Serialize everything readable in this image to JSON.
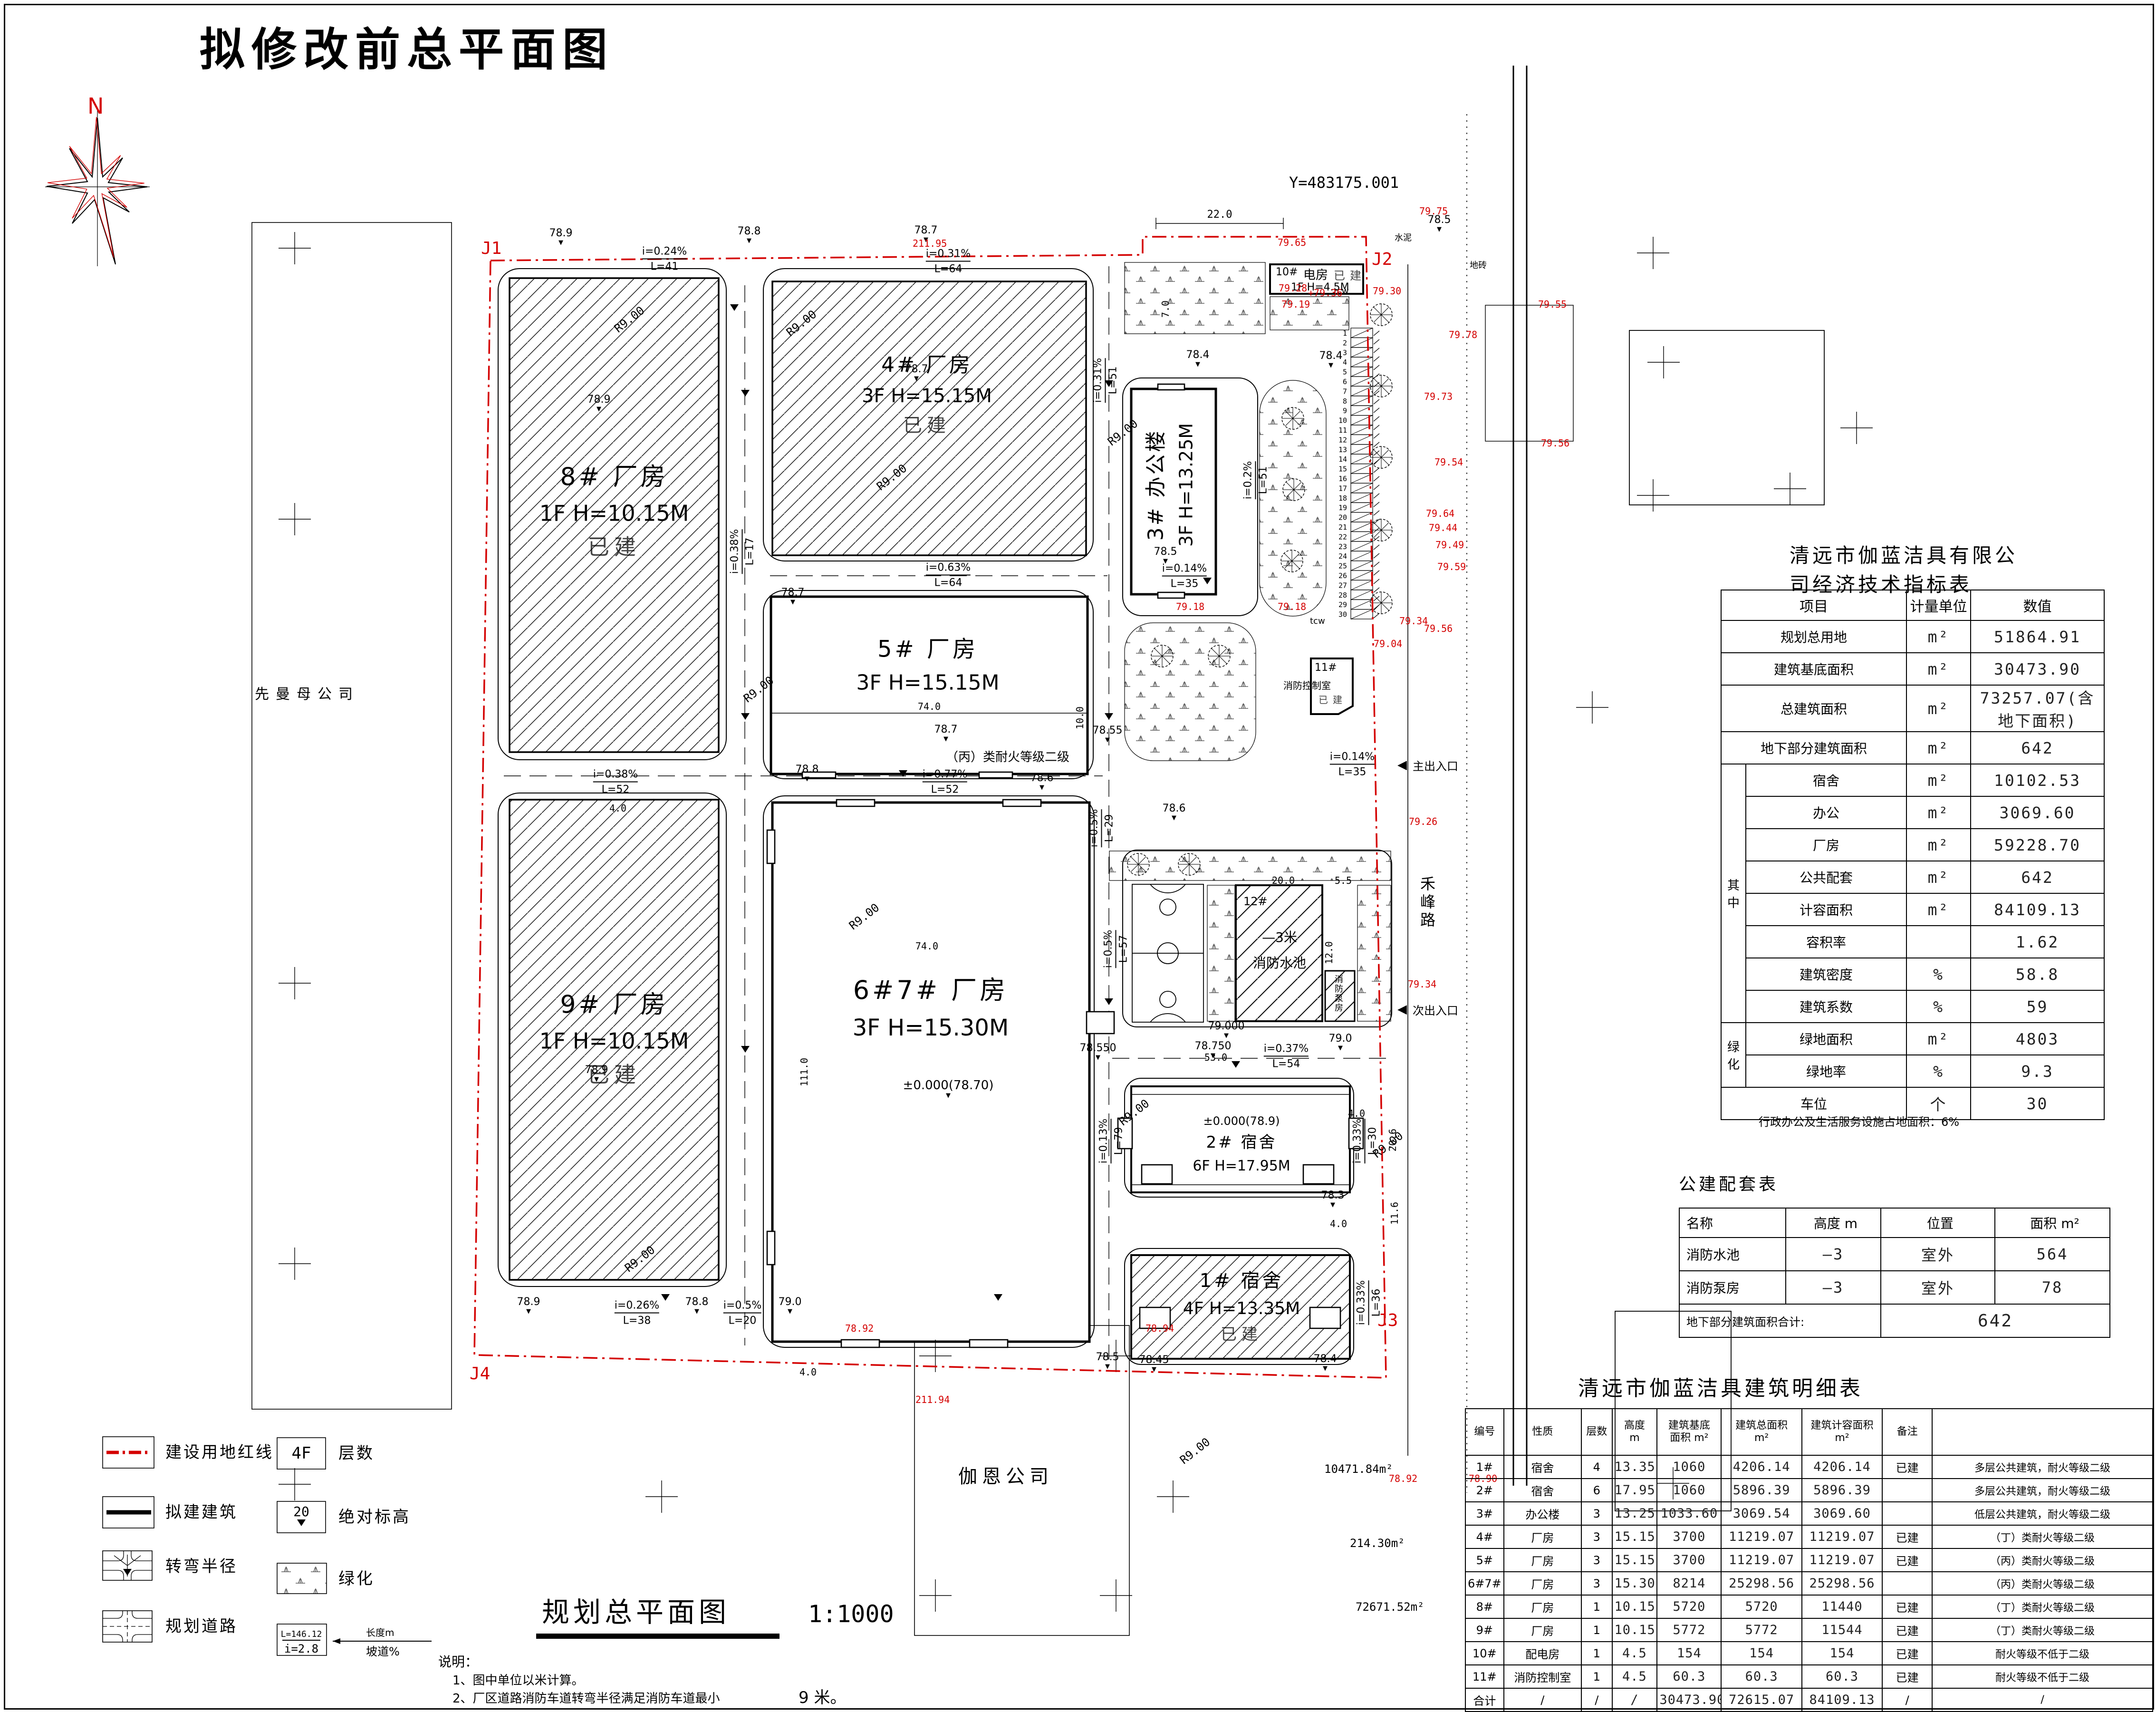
{
  "page": {
    "title": "拟修改前总平面图",
    "y_coord": "Y=483175.001"
  },
  "compass": {
    "n": "N"
  },
  "markers": {
    "j1": "J1",
    "j2": "J2",
    "j3": "J3",
    "j4": "J4"
  },
  "icons": {
    "spot": "▼",
    "left": "◀",
    "up": "▲"
  },
  "labels": {
    "r9": "R9.00",
    "hefeng": "禾峰路",
    "main_ent": "主出入口",
    "sec_ent": "次出入口",
    "cement": "水泥",
    "brick": "地砖",
    "tcw": "tcw"
  },
  "neighbors": {
    "west": "先曼母公司",
    "south": "伽恩公司"
  },
  "areas": {
    "a1": "10471.84m²",
    "a2": "214.30m²",
    "a3": "72671.52m²"
  },
  "buildings": {
    "b8": {
      "name": "8# 厂房",
      "spec": "1F H=10.15M",
      "status": "已建"
    },
    "b9": {
      "name": "9# 厂房",
      "spec": "1F H=10.15M",
      "status": "已建"
    },
    "b4": {
      "name": "4# 厂房",
      "spec": "3F H=15.15M",
      "status": "已建"
    },
    "b5": {
      "name": "5# 厂房",
      "spec": "3F H=15.15M",
      "fire": "（丙）类耐火等级二级"
    },
    "b67": {
      "name": "6#7# 厂房",
      "spec": "3F H=15.30M",
      "zero": "±0.000(78.70)"
    },
    "b3": {
      "name": "3# 办公楼",
      "spec": "3F H=13.25M"
    },
    "b2": {
      "zero": "±0.000(78.9)",
      "name": "2# 宿舍",
      "spec": "6F H=17.95M"
    },
    "b1": {
      "name": "1# 宿舍",
      "spec": "4F H=13.35M",
      "status": "已建"
    },
    "b10": {
      "id": "10#",
      "name": "电房",
      "spec": "1F H=4.5M",
      "status": "已建"
    },
    "b11": {
      "id": "11#",
      "name": "消防控制室",
      "status": "已建"
    },
    "b12": {
      "id": "12#",
      "depth": "—3米",
      "name": "消防水池",
      "pump": "消防泵房"
    }
  },
  "elevs": {
    "e1": "78.9",
    "e2": "78.8",
    "e3": "78.7",
    "e4": "78.5",
    "e5": "78.9",
    "e6": "78.7",
    "e7": "78.7",
    "e8": "78.4",
    "e9": "78.4",
    "e10": "78.5",
    "e11": "78.55",
    "e12": "78.7",
    "e13": "78.8",
    "e14": "78.6",
    "e15": "78.9",
    "e16": "78.550",
    "e17": "78.750",
    "e18": "79.000",
    "e19": "79.0",
    "e20": "78.3",
    "e21": "78.5",
    "e22": "78.45",
    "e23": "78.4",
    "e24": "78.9",
    "e25": "78.8",
    "e26": "79.0",
    "e27": "78.6"
  },
  "red": {
    "r1": "79.65",
    "r2": "79.28",
    "r3": "+79.36",
    "r4": "79.19",
    "r5": "79.30",
    "r6": "79.75",
    "r7": "79.78",
    "r8": "79.73",
    "r9": "79.54",
    "r10": "79.64",
    "r11": "79.44",
    "r12": "79.49",
    "r13": "79.59",
    "r14": "79.56",
    "r15": "79.34",
    "r16": "79.04",
    "r17": "79.18",
    "r18": "79.18",
    "r19": "79.55",
    "r20": "79.56",
    "r21": "211.95",
    "r22": "211.94",
    "r23": "78.92",
    "r24": "78.94",
    "r25": "78.92",
    "r26": "78.90",
    "r27": "79.26",
    "r28": "79.34"
  },
  "dims": {
    "d22": "22.0",
    "d7": "7.0",
    "d74a": "74.0",
    "d74b": "74.0",
    "d111": "111.0",
    "d53": "53.0",
    "d20": "20.0",
    "d12": "12.0",
    "d55": "5.5",
    "d206": "20.6",
    "d116": "11.6",
    "d40": "4.0",
    "d100": "10.0"
  },
  "slopes": {
    "s1": {
      "i": "i=0.24%",
      "l": "L=41"
    },
    "s2": {
      "i": "i=0.31%",
      "l": "L=64"
    },
    "s3": {
      "i": "i=0.63%",
      "l": "L=64"
    },
    "s4": {
      "i": "i=0.38%",
      "l": "L=17"
    },
    "s5": {
      "i": "i=0.38%",
      "l": "L=52"
    },
    "s6": {
      "i": "i=0.77%",
      "l": "L=52"
    },
    "s7": {
      "i": "i=0.26%",
      "l": "L=38"
    },
    "s8": {
      "i": "i=0.5%",
      "l": "L=20"
    },
    "s9": {
      "i": "i=0.14%",
      "l": "L=35"
    },
    "s10": {
      "i": "i=0.37%",
      "l": "L=54"
    },
    "s11": {
      "i": "i=0.13%",
      "l": "L=79"
    },
    "s12": {
      "i": "i=0.33%",
      "l": "L=30"
    },
    "s13": {
      "i": "i=0.33%",
      "l": "L=36"
    },
    "s14": {
      "i": "i=0.5%",
      "l": "L=57"
    },
    "s15": {
      "i": "i=0.2%",
      "l": "L=51"
    },
    "s16": {
      "i": "i=0.31%",
      "l": "L=51"
    },
    "s17": {
      "i": "i=0.5%",
      "l": "L=29"
    },
    "s18": {
      "i": "i=0.14%",
      "l": "L=35"
    }
  },
  "parking": {
    "count": 30
  },
  "legend": {
    "redline": "建设用地红线",
    "building": "拟建建筑",
    "turn": "转弯半径",
    "road": "规划道路",
    "floors": "层数",
    "floors_sym": "4F",
    "elev": "绝对标高",
    "elev_sym": "20",
    "green": "绿化",
    "slope_top": "L=146.12",
    "slope_bot": "i=2.8",
    "len_label": "长度m",
    "grade_label": "坡道%"
  },
  "caption": {
    "text": "规划总平面图",
    "scale": "1:1000"
  },
  "notes": {
    "head": "说明：",
    "n1": "1、图中单位以米计算。",
    "n2": "2、厂区道路消防车道转弯半径满足消防车道最小",
    "n2b": "9 米。"
  },
  "econ_table": {
    "title": "清远市伽蓝洁具有限公司经济技术指标表",
    "headers": [
      "项目",
      "计量单位",
      "数值"
    ],
    "rows": [
      {
        "item": "规划总用地",
        "unit": "m²",
        "value": "51864.91"
      },
      {
        "item": "建筑基底面积",
        "unit": "m²",
        "value": "30473.90"
      },
      {
        "item": "总建筑面积",
        "unit": "m²",
        "value": "73257.07(含地下面积)"
      },
      {
        "item": "地下部分建筑面积",
        "unit": "m²",
        "value": "642"
      },
      {
        "group": "其中",
        "span": 8,
        "item": "宿舍",
        "unit": "m²",
        "value": "10102.53"
      },
      {
        "item": "办公",
        "unit": "m²",
        "value": "3069.60"
      },
      {
        "item": "厂房",
        "unit": "m²",
        "value": "59228.70"
      },
      {
        "item": "公共配套",
        "unit": "m²",
        "value": "642"
      },
      {
        "item": "计容面积",
        "unit": "m²",
        "value": "84109.13"
      },
      {
        "item": "容积率",
        "unit": "",
        "value": "1.62"
      },
      {
        "item": "建筑密度",
        "unit": "%",
        "value": "58.8"
      },
      {
        "item": "建筑系数",
        "unit": "%",
        "value": "59"
      },
      {
        "group": "绿化",
        "span": 2,
        "item": "绿地面积",
        "unit": "m²",
        "value": "4803"
      },
      {
        "item": "绿地率",
        "unit": "%",
        "value": "9.3"
      },
      {
        "item": "车位",
        "unit": "个",
        "value": "30"
      }
    ],
    "footnote": "行政办公及生活服务设施占地面积：6%"
  },
  "public_table": {
    "title": "公建配套表",
    "headers": [
      "名称",
      "高度 m",
      "位置",
      "面积 m²"
    ],
    "rows": [
      [
        "消防水池",
        "—3",
        "室外",
        "564"
      ],
      [
        "消防泵房",
        "—3",
        "室外",
        "78"
      ]
    ],
    "total_label": "地下部分建筑面积合计:",
    "total_value": "642"
  },
  "detail_table": {
    "title": "清远市伽蓝洁具建筑明细表",
    "headers": [
      "编号",
      "性质",
      "层数",
      "高度\nm",
      "建筑基底\n面积 m²",
      "建筑总面积\nm²",
      "建筑计容面积\nm²",
      "备注",
      ""
    ],
    "rows": [
      [
        "1#",
        "宿舍",
        "4",
        "13.35",
        "1060",
        "4206.14",
        "4206.14",
        "已建",
        "多层公共建筑，耐火等级二级"
      ],
      [
        "2#",
        "宿舍",
        "6",
        "17.95",
        "1060",
        "5896.39",
        "5896.39",
        "",
        "多层公共建筑，耐火等级二级"
      ],
      [
        "3#",
        "办公楼",
        "3",
        "13.25",
        "1033.60",
        "3069.54",
        "3069.60",
        "",
        "低层公共建筑，耐火等级二级"
      ],
      [
        "4#",
        "厂房",
        "3",
        "15.15",
        "3700",
        "11219.07",
        "11219.07",
        "已建",
        "（丁）类耐火等级二级"
      ],
      [
        "5#",
        "厂房",
        "3",
        "15.15",
        "3700",
        "11219.07",
        "11219.07",
        "已建",
        "（丙）类耐火等级二级"
      ],
      [
        "6#7#",
        "厂房",
        "3",
        "15.30",
        "8214",
        "25298.56",
        "25298.56",
        "",
        "（丙）类耐火等级二级"
      ],
      [
        "8#",
        "厂房",
        "1",
        "10.15",
        "5720",
        "5720",
        "11440",
        "已建",
        "（丁）类耐火等级二级"
      ],
      [
        "9#",
        "厂房",
        "1",
        "10.15",
        "5772",
        "5772",
        "11544",
        "已建",
        "（丁）类耐火等级二级"
      ],
      [
        "10#",
        "配电房",
        "1",
        "4.5",
        "154",
        "154",
        "154",
        "已建",
        "耐火等级不低于二级"
      ],
      [
        "11#",
        "消防控制室",
        "1",
        "4.5",
        "60.3",
        "60.3",
        "60.3",
        "已建",
        "耐火等级不低于二级"
      ],
      [
        "合计",
        "/",
        "/",
        "/",
        "30473.90",
        "72615.07",
        "84109.13",
        "/",
        "/"
      ]
    ]
  }
}
